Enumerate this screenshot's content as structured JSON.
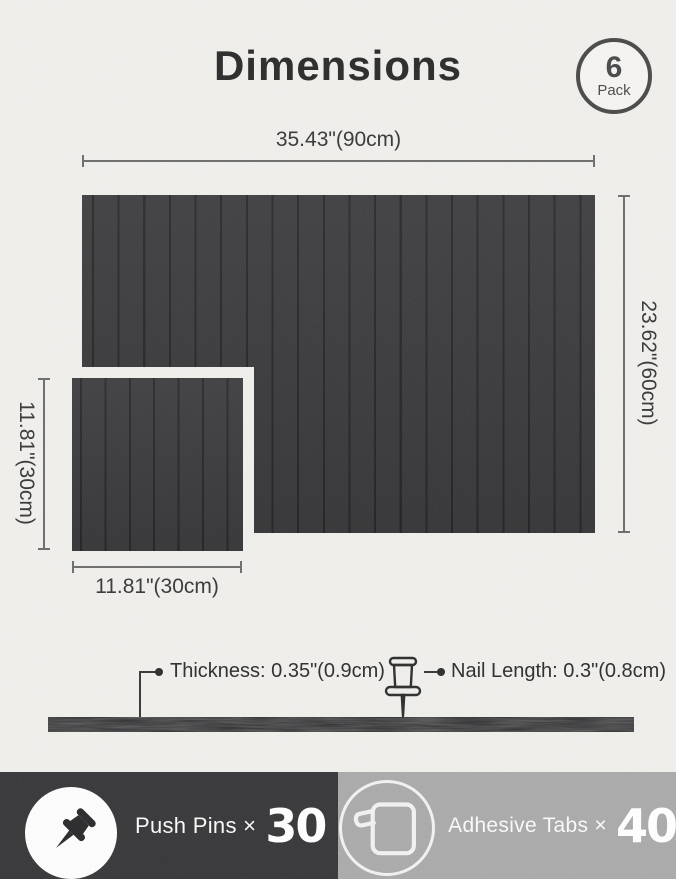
{
  "header": {
    "title": "Dimensions",
    "badge_count": "6",
    "badge_unit": "Pack"
  },
  "dims": {
    "width_large": "35.43\"(90cm)",
    "height_large": "23.62\"(60cm)",
    "height_small": "11.81\"(30cm)",
    "width_small": "11.81\"(30cm)",
    "thickness": "Thickness: 0.35\"(0.9cm)",
    "nail_length": "Nail Length: 0.3\"(0.8cm)"
  },
  "footer": {
    "pins_label": "Push Pins ×",
    "pins_count": "30",
    "tabs_label": "Adhesive Tabs ×",
    "tabs_count": "40"
  },
  "icons": {
    "pack_badge": "circle-badge",
    "pins": "pushpin-icon",
    "tabs": "adhesive-tab-icon",
    "nail": "pushpin-outline-icon"
  },
  "colors": {
    "background": "#f0efec",
    "panel": "#3b3b3d",
    "groove": "#27272a",
    "banner_dark": "#39393b",
    "banner_gray": "#ababab",
    "line": "#6e6e6e",
    "text": "#2f2f2f"
  }
}
